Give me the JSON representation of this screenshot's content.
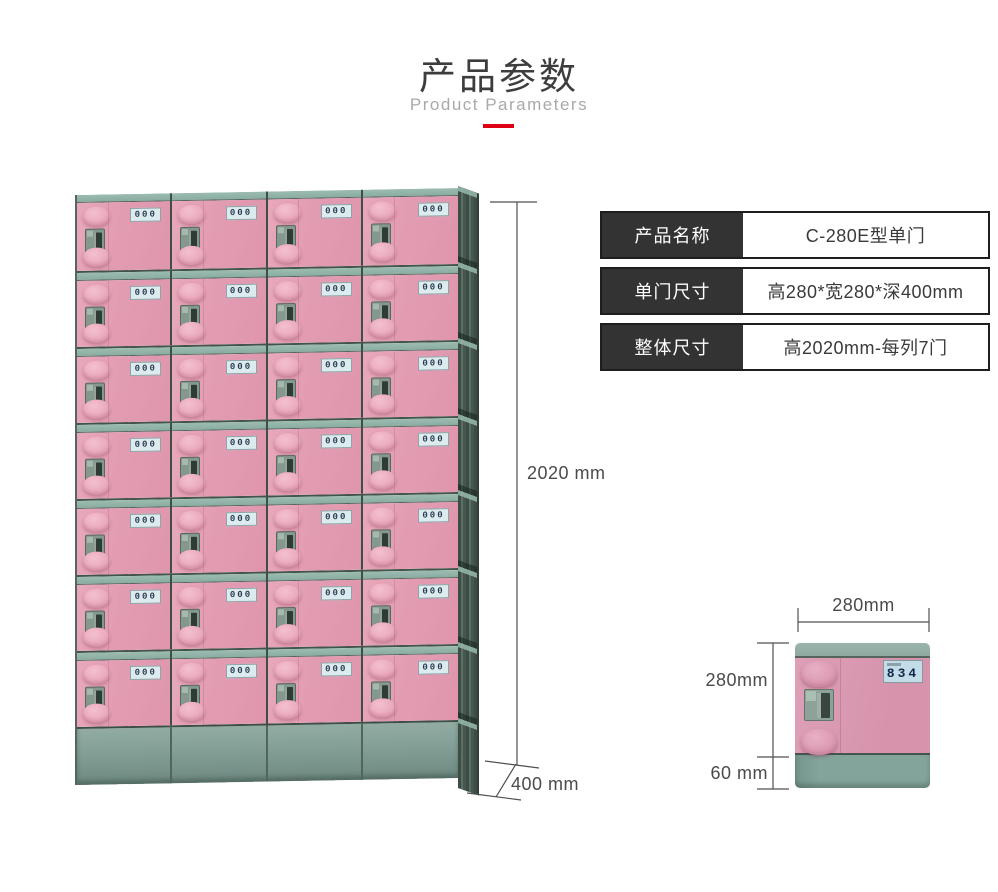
{
  "header": {
    "title": "产品参数",
    "subtitle": "Product Parameters"
  },
  "spec_table": {
    "rows": [
      {
        "label": "产品名称",
        "value": "C-280E型单门"
      },
      {
        "label": "单门尺寸",
        "value": "高280*宽280*深400mm"
      },
      {
        "label": "整体尺寸",
        "value": "高2020mm-每列7门"
      }
    ]
  },
  "locker": {
    "columns": 4,
    "rows": 7,
    "door_plate_text": "000",
    "height_dimension": "2020 mm",
    "depth_dimension": "400 mm"
  },
  "door_detail": {
    "door_number": "834",
    "width_dimension": "280mm",
    "height_dimension": "280mm",
    "base_dimension": "60 mm"
  },
  "colors": {
    "accent_red": "#dc0012",
    "door_pink": "#e29cb2",
    "frame_teal": "#8faca1",
    "table_label_bg": "#333333"
  }
}
